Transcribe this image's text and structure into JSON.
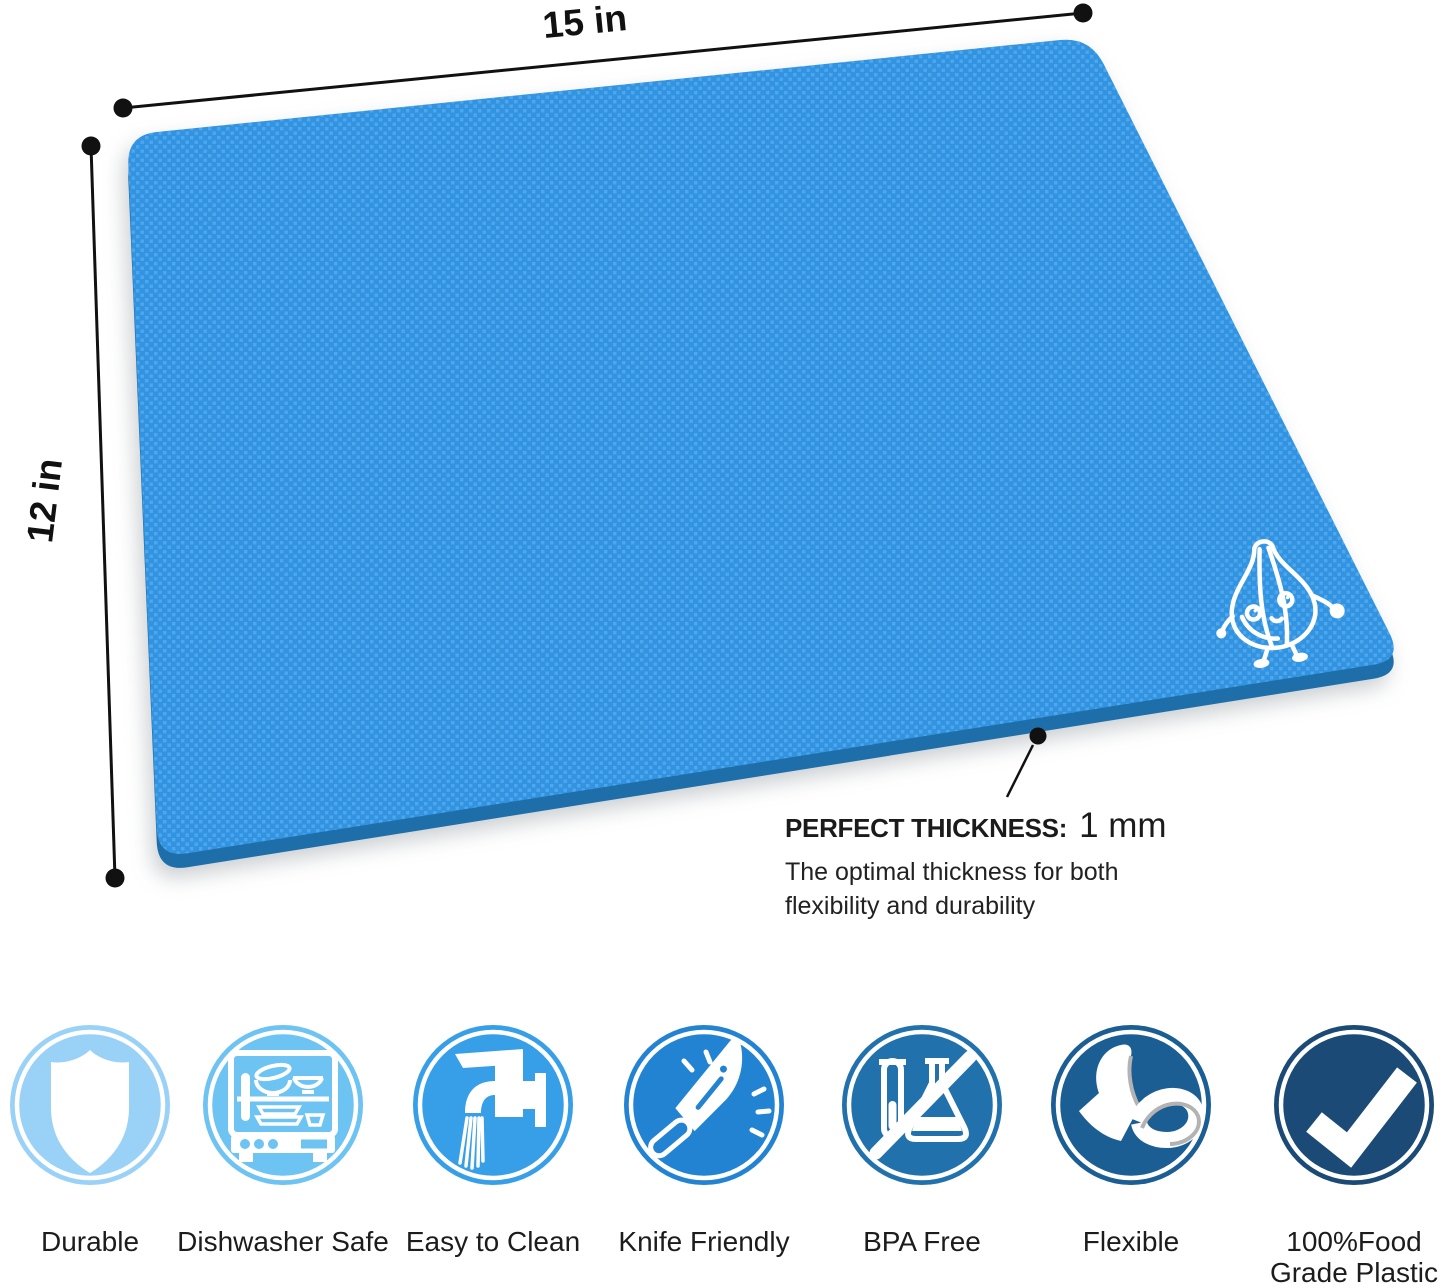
{
  "dimensions": {
    "width_label": "15 in",
    "height_label": "12 in"
  },
  "mat": {
    "surface_color": "#3094E3",
    "edge_color": "#1E6FA9",
    "logo": "garlic-mascot"
  },
  "thickness_callout": {
    "title": "PERFECT THICKNESS:",
    "value": "1 mm",
    "description_line1": "The optimal thickness for both",
    "description_line2": "flexibility and durability"
  },
  "features": [
    {
      "label": "Durable",
      "icon": "shield-icon",
      "circle_color": "#9AD2F7"
    },
    {
      "label": "Dishwasher Safe",
      "icon": "dishwasher-icon",
      "circle_color": "#6DC3F2"
    },
    {
      "label": "Easy to Clean",
      "icon": "faucet-icon",
      "circle_color": "#379FE8"
    },
    {
      "label": "Knife Friendly",
      "icon": "knife-icon",
      "circle_color": "#2383D3"
    },
    {
      "label": "BPA Free",
      "icon": "no-chemicals-icon",
      "circle_color": "#2171AC"
    },
    {
      "label": "Flexible",
      "icon": "bent-mat-icon",
      "circle_color": "#1B5E94"
    },
    {
      "label": "100%Food Grade Plastic",
      "icon": "checkmark-icon",
      "circle_color": "#1A4A75"
    }
  ]
}
